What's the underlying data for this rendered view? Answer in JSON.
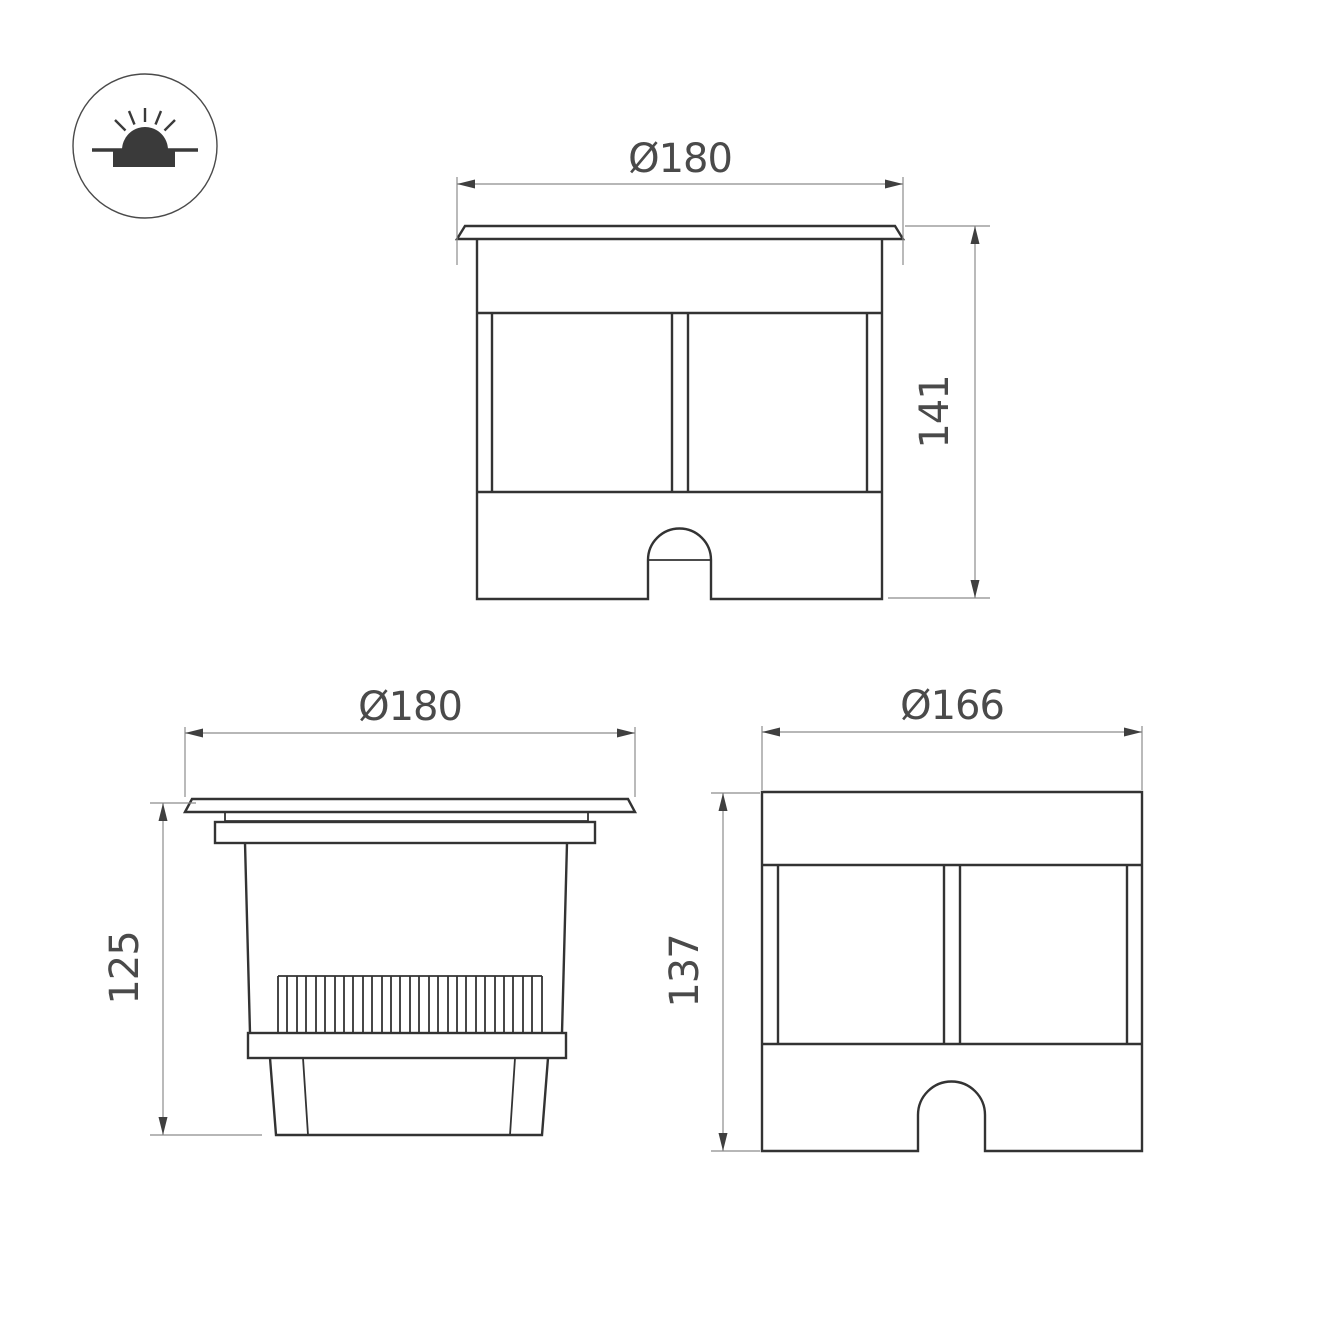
{
  "icon": {
    "name": "inground-light-icon",
    "meaning": "recessed ground luminaire symbol"
  },
  "views": {
    "front": {
      "width_label": "Ø180",
      "height_label": "141"
    },
    "side": {
      "width_label": "Ø180",
      "height_label": "125"
    },
    "front_alt": {
      "width_label": "Ø166",
      "height_label": "137"
    }
  },
  "colors": {
    "object_line": "#333333",
    "dimension_line": "#8c8c8c",
    "arrowhead": "#3f3f3f",
    "text": "#4a4a4a",
    "icon_fill": "#3a3a3a",
    "background": "#ffffff"
  }
}
